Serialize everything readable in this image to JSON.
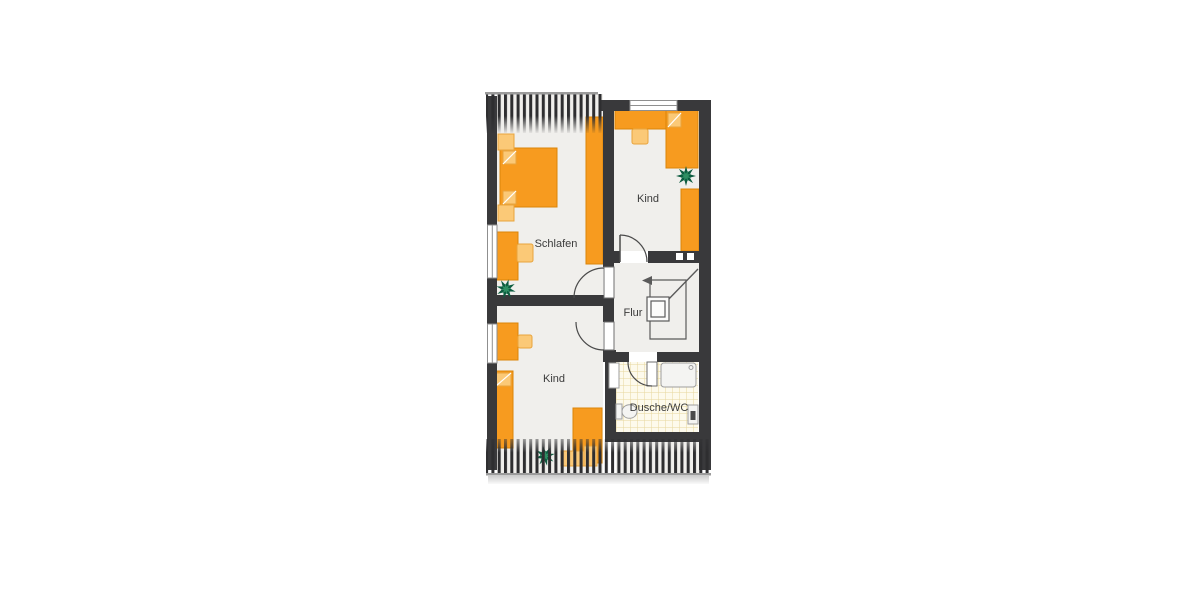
{
  "rooms": {
    "schlafen": {
      "label": "Schlafen"
    },
    "kind_top": {
      "label": "Kind"
    },
    "flur": {
      "label": "Flur"
    },
    "kind_bottom": {
      "label": "Kind"
    },
    "dusche_wc": {
      "label": "Dusche/WC"
    }
  },
  "colors": {
    "background": "#ffffff",
    "wall": "#39393b",
    "floor": "#f0efec",
    "furniture": "#f79b1f",
    "furniture_stroke": "#db8408",
    "furniture_light": "#fbc977",
    "furniture_light_stroke": "#e8a43c",
    "tile_bg": "#fdfaec",
    "tile_line": "#e6d79d",
    "fixture_fill": "#f4f4f2",
    "fixture_stroke": "#9e9e9e",
    "fixture_dark": "#4a4a4a",
    "hatch": "#2e2e30",
    "edge_line": "#9b9b9b",
    "door_line": "#4a4a4a",
    "stair_line": "#5a5a5a",
    "plant_dark": "#0d5c40",
    "plant_light": "#2f8f63",
    "label": "#3b3b3b"
  }
}
